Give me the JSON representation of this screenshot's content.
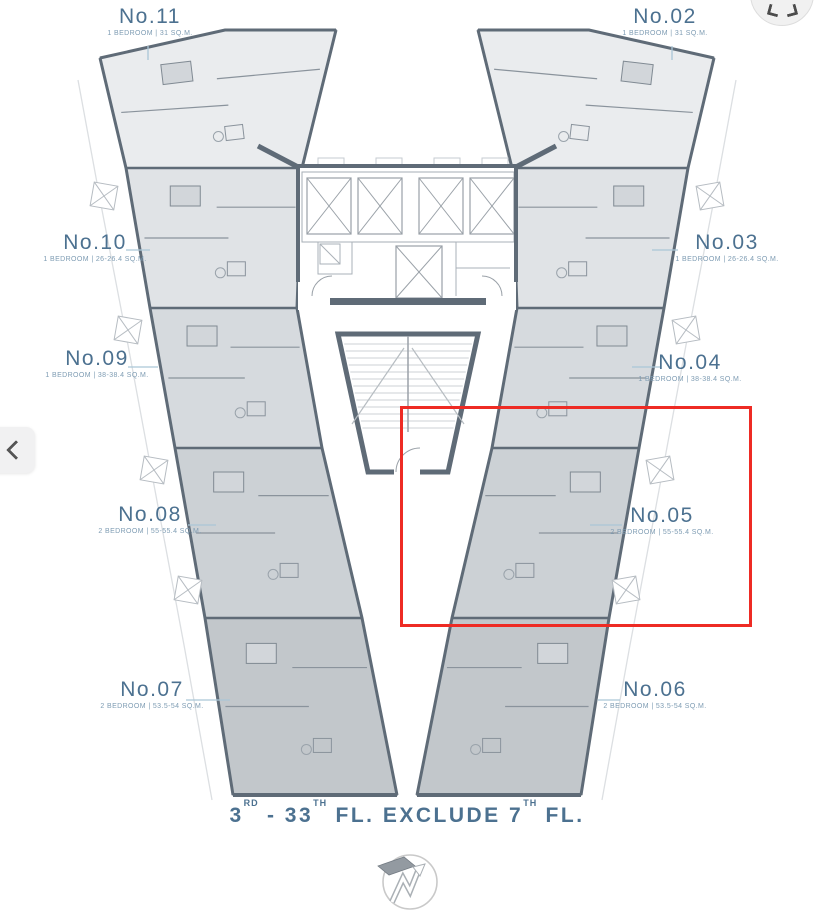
{
  "plan": {
    "units": [
      {
        "id": "no-11",
        "label": "No.11",
        "spec": "1 BEDROOM | 31 SQ.M."
      },
      {
        "id": "no-02",
        "label": "No.02",
        "spec": "1 BEDROOM | 31 SQ.M."
      },
      {
        "id": "no-10",
        "label": "No.10",
        "spec": "1 BEDROOM | 26-26.4 SQ.M."
      },
      {
        "id": "no-03",
        "label": "No.03",
        "spec": "1 BEDROOM | 26-26.4 SQ.M."
      },
      {
        "id": "no-09",
        "label": "No.09",
        "spec": "1 BEDROOM | 38-38.4 SQ.M."
      },
      {
        "id": "no-04",
        "label": "No.04",
        "spec": "1 BEDROOM | 38-38.4 SQ.M."
      },
      {
        "id": "no-08",
        "label": "No.08",
        "spec": "2 BEDROOM | 55-55.4 SQ.M."
      },
      {
        "id": "no-05",
        "label": "No.05",
        "spec": "2 BEDROOM | 55-55.4 SQ.M.",
        "highlighted": true
      },
      {
        "id": "no-07",
        "label": "No.07",
        "spec": "2 BEDROOM | 53.5-54 SQ.M."
      },
      {
        "id": "no-06",
        "label": "No.06",
        "spec": "2 BEDROOM | 53.5-54 SQ.M."
      }
    ],
    "highlight": {
      "unit": "No.05",
      "color": "#ee2b24"
    },
    "footer": {
      "p1": "3",
      "s1": "RD",
      "p2": " - 33",
      "s2": "TH",
      "p3": " FL. EXCLUDE 7",
      "s3": "TH",
      "p4": " FL."
    },
    "core": {
      "elevators": 4,
      "service_elevator": 1,
      "stairs": "scissor-stair"
    }
  },
  "controls": {
    "prev_button": {
      "icon": "chevron-left-icon"
    },
    "expand_button": {
      "icon": "double-chevron-down-icon"
    }
  },
  "compass": {
    "icon": "north-arrow-icon"
  },
  "colors": {
    "label_text": "#4c7190",
    "label_subtext": "#7e9cb3",
    "wall": "#5f6b77",
    "unit_fill_lightest": "#eaecee",
    "unit_fill_darkest": "#c2c7cb",
    "highlight": "#ee2b24",
    "leader_line": "#aac6d7"
  }
}
